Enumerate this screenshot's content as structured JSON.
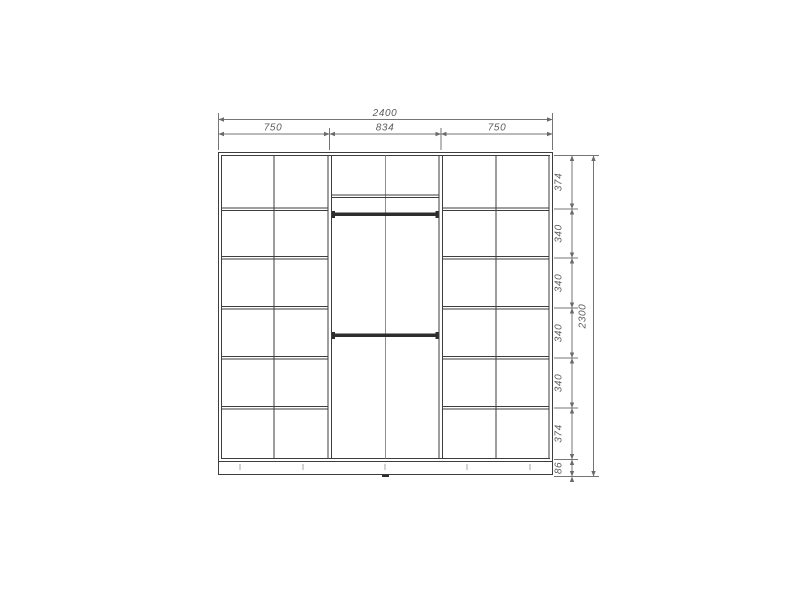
{
  "drawing": {
    "dims": {
      "overall_width": "2400",
      "overall_height": "2300",
      "top_sections": [
        "750",
        "834",
        "750"
      ],
      "right_chain": [
        "374",
        "340",
        "340",
        "340",
        "340",
        "374",
        "86"
      ]
    },
    "colors": {
      "background": "#ffffff",
      "carcass_line": "#3d3d3d",
      "dimension_line": "#757575",
      "rod": "#2d2d2d",
      "text": "#5c5c5c"
    }
  }
}
